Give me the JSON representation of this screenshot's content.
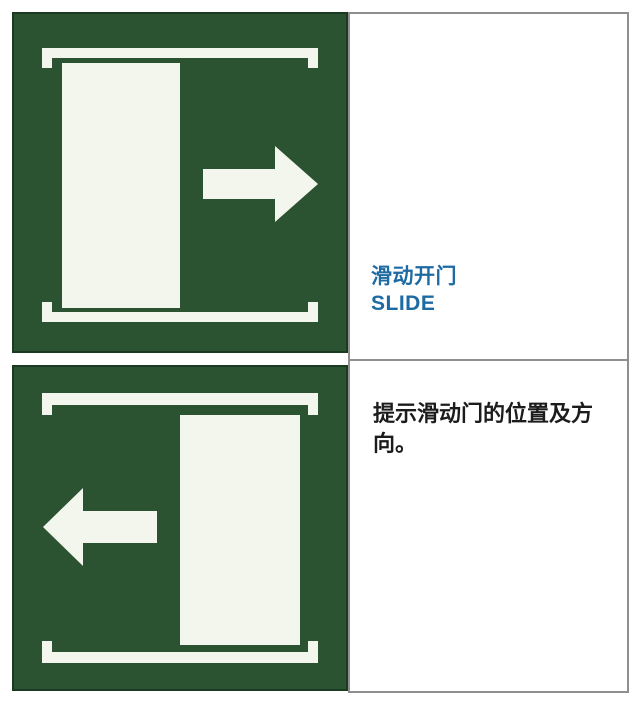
{
  "sign_entry": {
    "title_cn": "滑动开门",
    "title_en": "SLIDE",
    "description": "提示滑动门的位置及方向。",
    "description_lines": [
      "提示滑动门的位置及方",
      "向。"
    ]
  },
  "signs": [
    {
      "id": "slide-door-right",
      "door_side": "left",
      "arrow_direction": "right"
    },
    {
      "id": "slide-door-left",
      "door_side": "right",
      "arrow_direction": "left"
    }
  ],
  "colors": {
    "sign_green": "#2b5231",
    "sign_edge_green": "#1c3a22",
    "symbol_white": "#f3f6ec",
    "title_blue": "#1e6ba3",
    "description_text": "#1c1c1c",
    "cell_border": "#8f8f8f"
  }
}
